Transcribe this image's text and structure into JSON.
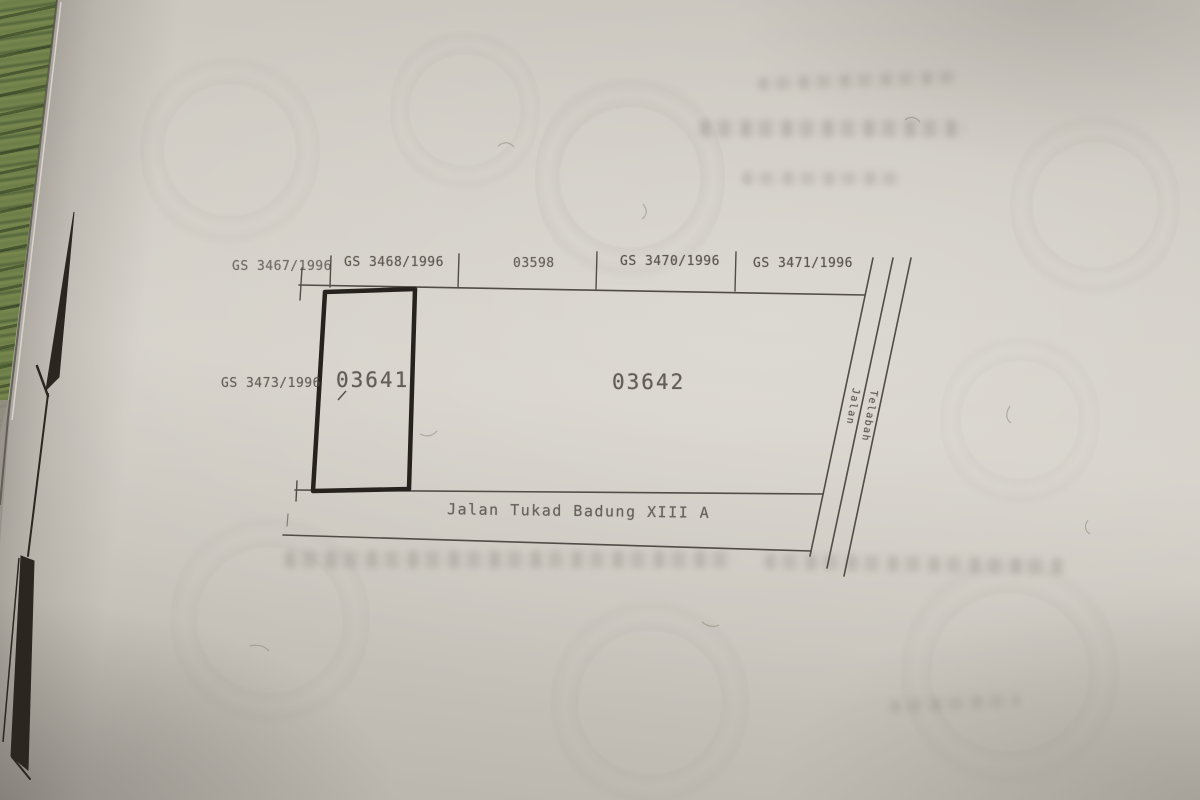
{
  "plan": {
    "top_parcels": [
      {
        "label": "GS 3467/1996"
      },
      {
        "label": "GS 3468/1996"
      },
      {
        "label": "03598"
      },
      {
        "label": "GS 3470/1996"
      },
      {
        "label": "GS 3471/1996"
      }
    ],
    "left_parcel": {
      "label": "GS 3473/1996"
    },
    "parcels": {
      "main": "03641",
      "right": "03642"
    },
    "streets": {
      "bottom": "Jalan Tukad Badung XIII A",
      "right": [
        "Jalan",
        "Telabah"
      ]
    }
  },
  "colors": {
    "paper": "#d2cec6",
    "line_ink": "#46413b",
    "plot_outline_ink": "#26221d",
    "arrow_ink": "#2c2620",
    "green_mat": "#6f804b"
  }
}
